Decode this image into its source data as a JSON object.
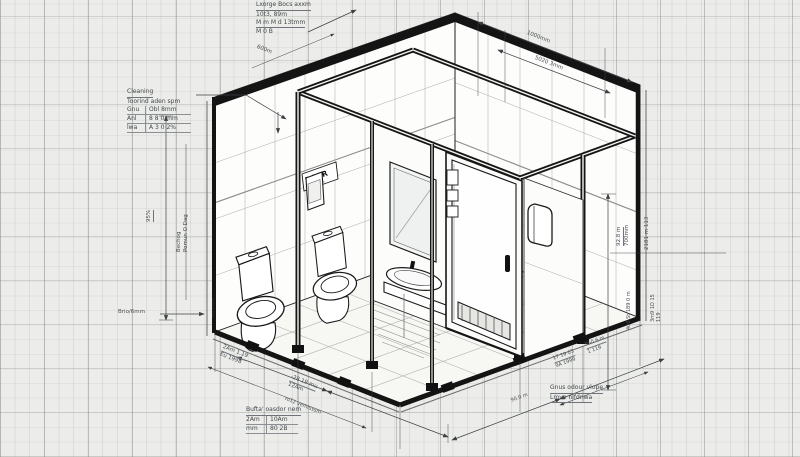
{
  "drawing": {
    "kind": "isometric restroom module construction drawing",
    "door_sign": "DOER",
    "door_sign_sub": "2t-79t3 99m"
  },
  "colors": {
    "paper": "#ecedea",
    "grid_major": "#7d827a",
    "grid_minor": "#8c918a",
    "ink": "#161616",
    "annotation": "#4a4e53",
    "wall_fill": "#fdfdfc",
    "floor_fill": "#f7f7f4"
  },
  "notes": {
    "top_left": {
      "line1": "Lxorge Bocs axxm",
      "line2": "10t3, 89m",
      "line3": "M m M d 13tmm",
      "line4": "M 0      B"
    },
    "cleaning": {
      "title": "Cleaning",
      "subtitle": "Toorind aden spm",
      "rows": [
        [
          "Gnu",
          "Obl 8mm"
        ],
        [
          "Anl",
          "8 8 0 mm"
        ],
        [
          "lwa",
          "A 3 0 2%"
        ]
      ]
    },
    "buffer": {
      "title": "Bufta' oasdor nem",
      "rows": [
        [
          "2Am",
          "10Am"
        ],
        [
          "mm",
          "80 2B"
        ]
      ]
    },
    "slope": {
      "line1": "Gnus odour vlope",
      "line2": "Lmvn nlfdnwa"
    }
  },
  "dims": {
    "top_diag": "600m",
    "top1": "1000mm",
    "top2": "5020 3mm",
    "left_pct": "95%",
    "left_v1": "Bechog",
    "left_v2": "Pomun O Dag",
    "left_leader": "Brio/6mm",
    "right1a": "92.8 m",
    "right1b": "700mm",
    "right2": "2181 m 113",
    "right3": "4u0 St 189 0 m",
    "right4a": "3m9 1D 15",
    "right4b": "119",
    "bl1a": "2Am 1.19",
    "bl1b": "Eu 1998",
    "bl2a": "-28 19 mu",
    "bl2b": "12Am",
    "bl3": "ro12 vemtsssm",
    "br1a": "17 19 03",
    "br1b": "9A 1999",
    "br2a": "950.6 m",
    "br2b": "1 119",
    "br3": "90.0 m"
  }
}
